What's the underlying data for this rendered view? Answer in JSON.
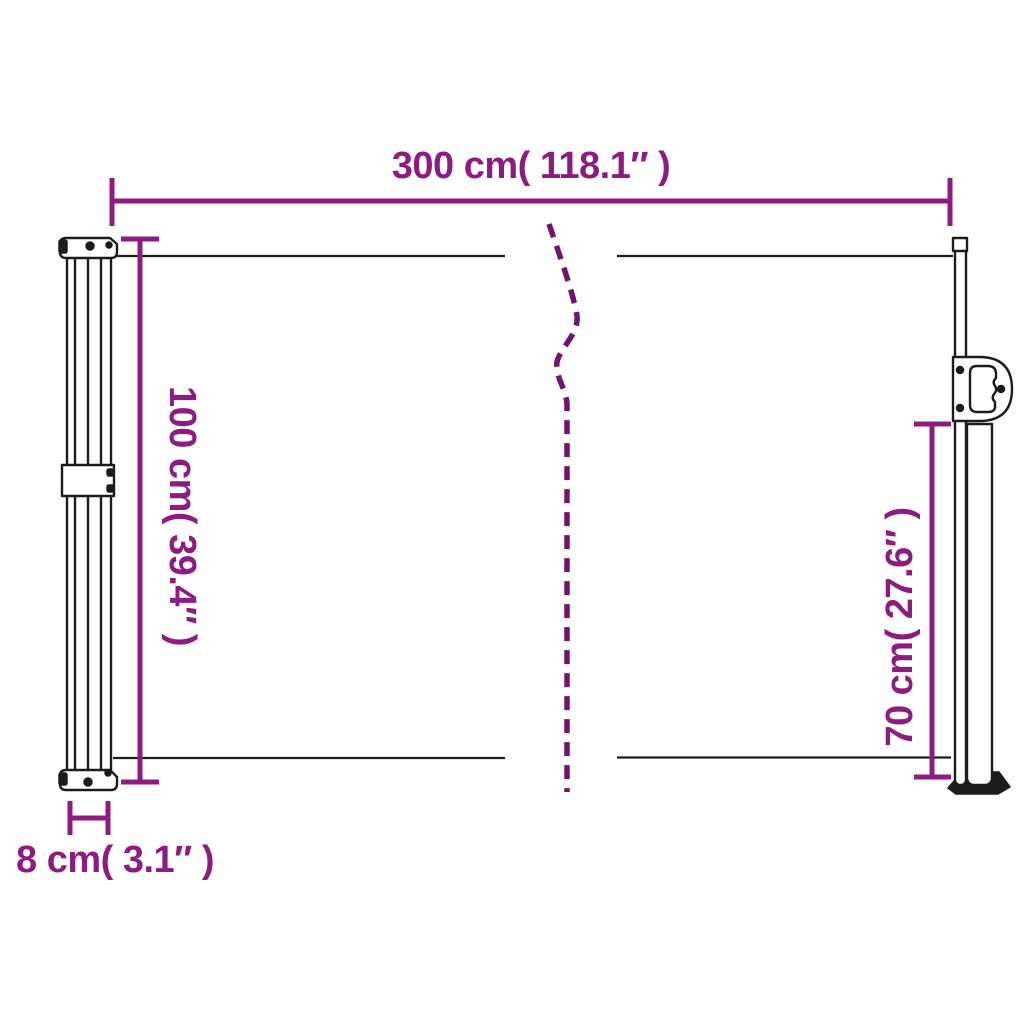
{
  "diagram": {
    "colors": {
      "accent": "#8D1B80",
      "break": "#73146B",
      "outline": "#1C1C1C",
      "background": "#FFFFFF"
    },
    "labels": {
      "width": "300 cm( 118.1″ )",
      "height": "100 cm( 39.4″ )",
      "pole_height": "70 cm( 27.6″ )",
      "depth": "8 cm( 3.1″ )"
    }
  }
}
